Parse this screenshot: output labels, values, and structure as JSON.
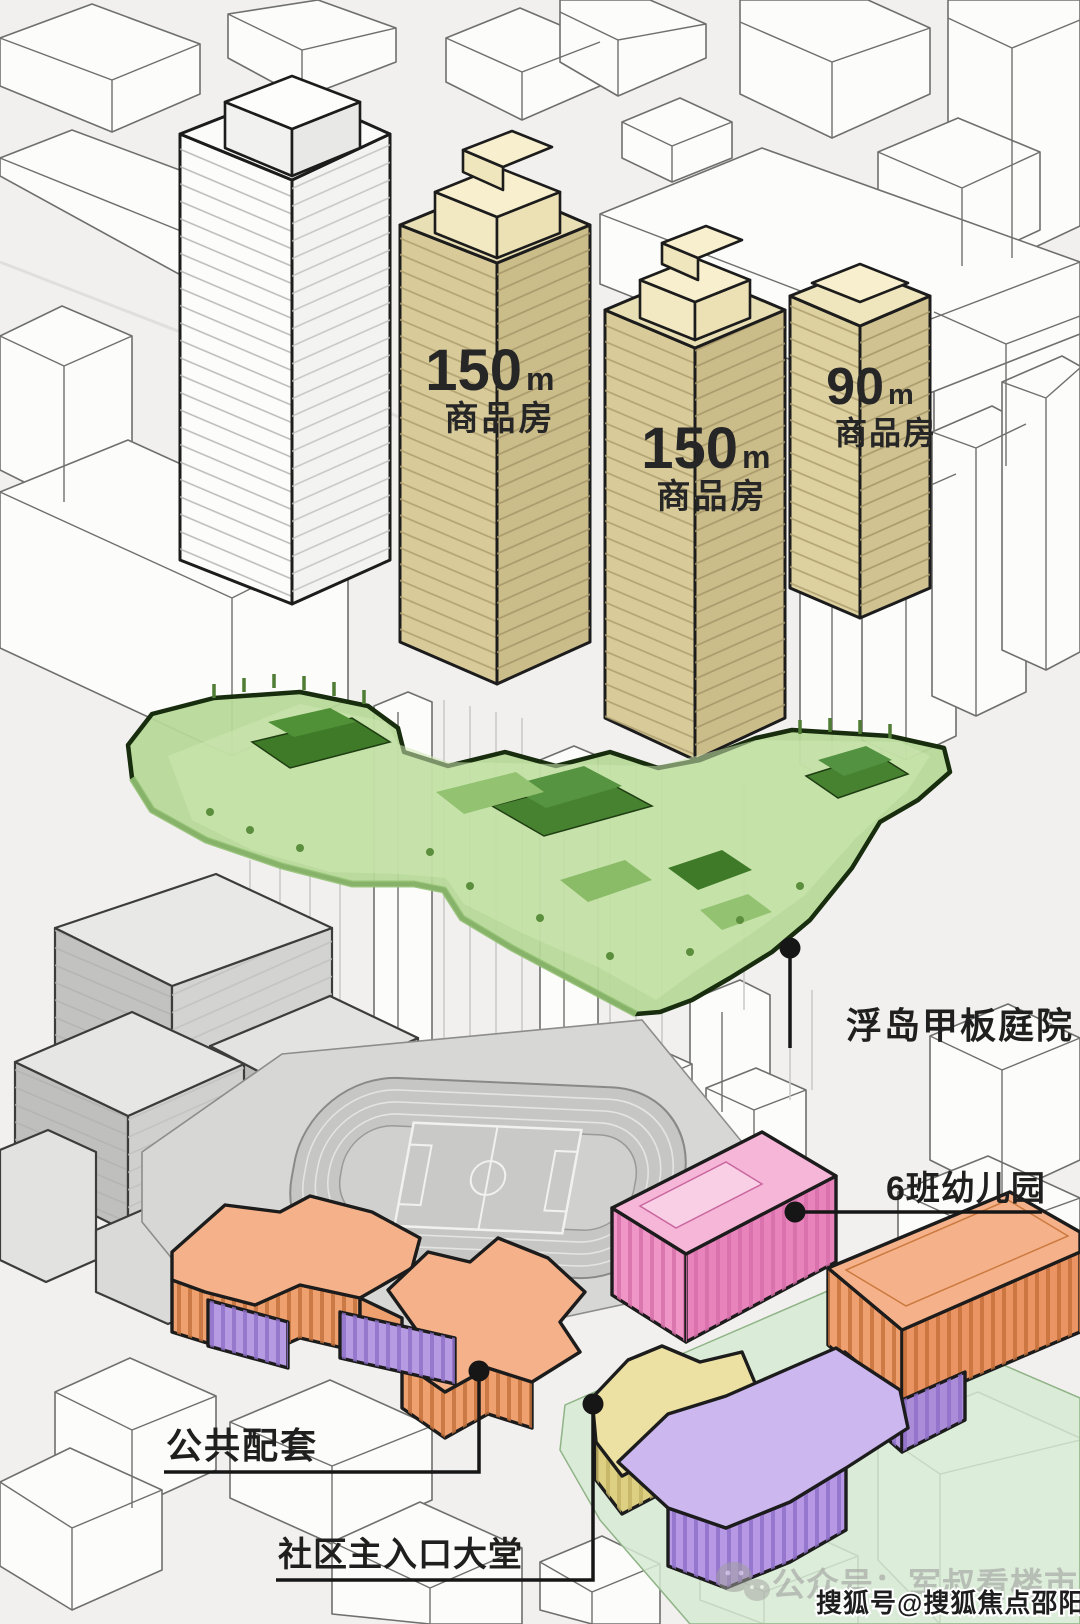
{
  "towers": [
    {
      "height": "150",
      "unit": "m",
      "use": "商品房"
    },
    {
      "height": "150",
      "unit": "m",
      "use": "商品房"
    },
    {
      "height": "90",
      "unit": "m",
      "use": "商品房"
    }
  ],
  "callouts": {
    "deck": "浮岛甲板庭院",
    "kindergarten": "6班幼儿园",
    "public_amenities": "公共配套",
    "community_lobby": "社区主入口大堂"
  },
  "watermarks": {
    "wechat": "公众号：军叔看楼市",
    "sohu": "搜狐号@搜狐焦点邵阳站"
  },
  "legend_colors": {
    "residential_tower_beige": "#d8cb99",
    "deck_garden_green": "#b7d998",
    "kindergarten_pink": "#f2a6ce",
    "public_amenities_orange": "#f0a274",
    "podium_purple": "#bb9fe6",
    "lobby_yellow": "#ece0a2",
    "school_track_gray": "#c6c6c4"
  }
}
